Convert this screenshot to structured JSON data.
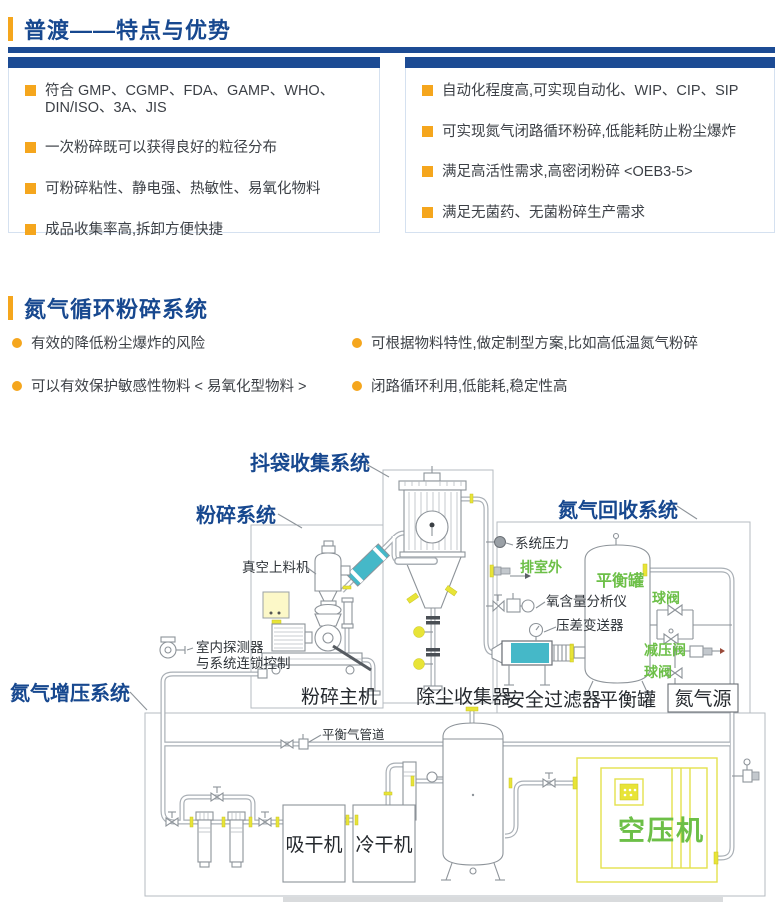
{
  "section1": {
    "title": "普渡——特点与优势",
    "left_items": [
      "符合 GMP、CGMP、FDA、GAMP、WHO、DIN/ISO、3A、JIS",
      "一次粉碎既可以获得良好的粒径分布",
      "可粉碎粘性、静电强、热敏性、易氧化物料",
      "成品收集率高,拆卸方便快捷"
    ],
    "right_items": [
      "自动化程度高,可实现自动化、WIP、CIP、SIP",
      "可实现氮气闭路循环粉碎,低能耗防止粉尘爆炸",
      "满足高活性需求,高密闭粉碎 <OEB3-5>",
      "满足无菌药、无菌粉碎生产需求"
    ]
  },
  "section2": {
    "title": "氮气循环粉碎系统",
    "left_items": [
      "有效的降低粉尘爆炸的风险",
      "可以有效保护敏感性物料 < 易氧化型物料 >"
    ],
    "right_items": [
      "可根据物料特性,做定制型方案,比如高低温氮气粉碎",
      "闭路循环利用,低能耗,稳定性高"
    ]
  },
  "diagram": {
    "systems": {
      "bag_collection": "抖袋收集系统",
      "grinding": "粉碎系统",
      "nitrogen_recovery": "氮气回收系统",
      "nitrogen_boost": "氮气增压系统"
    },
    "equipment": {
      "vacuum_feeder": "真空上料机",
      "mill_unit": "粉碎主机",
      "dust_collector": "除尘收集器",
      "safety_filter": "安全过滤器",
      "balance_tank_tag": "平衡罐",
      "balance_tank": "平衡罐",
      "nitrogen_source": "氮气源",
      "absorption_dryer": "吸干机",
      "refrigerated_dryer": "冷干机",
      "air_compressor": "空压机"
    },
    "annotations": {
      "system_pressure": "系统压力",
      "exhaust_outdoor": "排室外",
      "oxygen_analyzer": "氧含量分析仪",
      "dp_transmitter": "压差变送器",
      "indoor_detector_1": "室内探测器",
      "indoor_detector_2": "与系统连锁控制",
      "balance_gas_pipe": "平衡气管道",
      "ball_valve_upper": "球阀",
      "pressure_reducing_valve": "减压阀",
      "ball_valve_lower": "球阀"
    },
    "colors": {
      "label_blue": "#17488f",
      "bar_blue": "#1c4b94",
      "accent_orange": "#f5a61d",
      "label_green": "#6cbf47",
      "pipe_gray": "#a9afb5",
      "teal": "#45b8c8",
      "accent_yellow": "#e8e437"
    }
  }
}
